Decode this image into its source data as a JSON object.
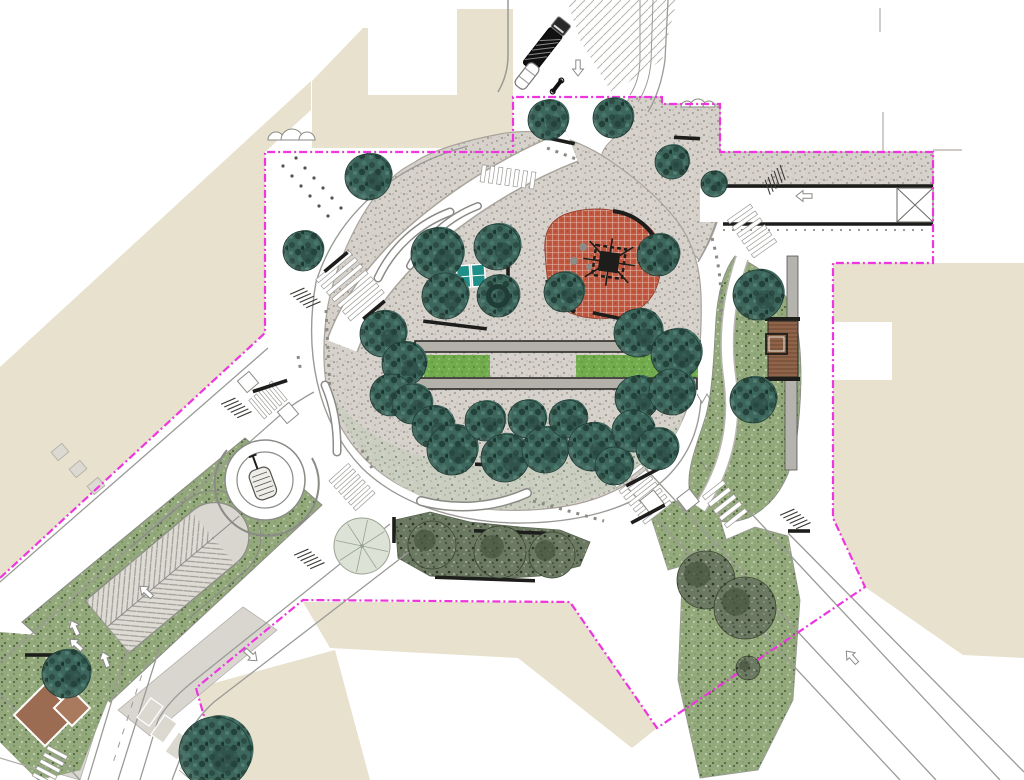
{
  "colors": {
    "building": "#e7e1cd",
    "boundary": "#ee35df",
    "gravelBase": "#d6d2cb",
    "gravelGreenBase": "#c9cdbf",
    "lawnBase": "#72ab4e",
    "plantBase": "#93a97c",
    "shrubBase": "#6b7862",
    "treeBase": "#3c655c",
    "playRed": "#c2573f",
    "deckWood": "#8a5f45",
    "sandBrown": "#9b6c52",
    "roadLine": "#9a9a96",
    "curb": "#1d1d1b"
  },
  "trees": [
    {
      "x": 548,
      "y": 120,
      "r": 20
    },
    {
      "x": 613,
      "y": 118,
      "r": 20
    },
    {
      "x": 672,
      "y": 162,
      "r": 17
    },
    {
      "x": 714,
      "y": 184,
      "r": 13
    },
    {
      "x": 368,
      "y": 177,
      "r": 23
    },
    {
      "x": 303,
      "y": 251,
      "r": 20
    },
    {
      "x": 437,
      "y": 254,
      "r": 26
    },
    {
      "x": 497,
      "y": 247,
      "r": 23
    },
    {
      "x": 445,
      "y": 296,
      "r": 23
    },
    {
      "x": 498,
      "y": 296,
      "r": 21,
      "donut": true
    },
    {
      "x": 564,
      "y": 292,
      "r": 20
    },
    {
      "x": 658,
      "y": 255,
      "r": 21
    },
    {
      "x": 383,
      "y": 334,
      "r": 23
    },
    {
      "x": 404,
      "y": 364,
      "r": 22
    },
    {
      "x": 391,
      "y": 395,
      "r": 21
    },
    {
      "x": 412,
      "y": 404,
      "r": 20
    },
    {
      "x": 433,
      "y": 427,
      "r": 21
    },
    {
      "x": 452,
      "y": 450,
      "r": 25
    },
    {
      "x": 485,
      "y": 421,
      "r": 20
    },
    {
      "x": 505,
      "y": 458,
      "r": 24
    },
    {
      "x": 527,
      "y": 419,
      "r": 19
    },
    {
      "x": 545,
      "y": 450,
      "r": 23
    },
    {
      "x": 568,
      "y": 419,
      "r": 19
    },
    {
      "x": 592,
      "y": 447,
      "r": 24
    },
    {
      "x": 638,
      "y": 333,
      "r": 24
    },
    {
      "x": 676,
      "y": 354,
      "r": 25
    },
    {
      "x": 637,
      "y": 398,
      "r": 22
    },
    {
      "x": 672,
      "y": 392,
      "r": 23
    },
    {
      "x": 633,
      "y": 431,
      "r": 21
    },
    {
      "x": 657,
      "y": 449,
      "r": 21
    },
    {
      "x": 614,
      "y": 466,
      "r": 19
    },
    {
      "x": 758,
      "y": 295,
      "r": 25
    },
    {
      "x": 753,
      "y": 400,
      "r": 23
    },
    {
      "x": 66,
      "y": 674,
      "r": 24
    },
    {
      "x": 215,
      "y": 753,
      "r": 36
    }
  ],
  "sketchTrees": [
    {
      "x": 362,
      "y": 546,
      "r": 28
    }
  ],
  "shrubBlobs": [
    {
      "x": 432,
      "y": 545,
      "r": 24
    },
    {
      "x": 500,
      "y": 552,
      "r": 26
    },
    {
      "x": 552,
      "y": 555,
      "r": 23
    },
    {
      "x": 706,
      "y": 580,
      "r": 29
    },
    {
      "x": 745,
      "y": 608,
      "r": 31
    },
    {
      "x": 748,
      "y": 668,
      "r": 12
    }
  ],
  "bikeRacks": [
    {
      "x": 303,
      "y": 296,
      "a": 40
    },
    {
      "x": 234,
      "y": 406,
      "a": 40
    },
    {
      "x": 773,
      "y": 182,
      "a": -45
    },
    {
      "x": 793,
      "y": 517,
      "a": 40
    },
    {
      "x": 307,
      "y": 557,
      "a": 40
    }
  ],
  "arrows": [
    {
      "x": 578,
      "y": 60,
      "a": 90
    },
    {
      "x": 812,
      "y": 196,
      "a": 180
    },
    {
      "x": 152,
      "y": 597,
      "a": 222
    },
    {
      "x": 82,
      "y": 650,
      "a": 222
    },
    {
      "x": 245,
      "y": 650,
      "a": 42
    },
    {
      "x": 857,
      "y": 663,
      "a": 228
    },
    {
      "x": 700,
      "y": 588,
      "a": 48
    },
    {
      "x": 108,
      "y": 667,
      "a": 250
    },
    {
      "x": 78,
      "y": 635,
      "a": 245
    }
  ],
  "parkingBays": [
    {
      "x": 150,
      "y": 712,
      "a": -55
    },
    {
      "x": 164,
      "y": 729,
      "a": -55
    },
    {
      "x": 178,
      "y": 746,
      "a": -55
    },
    {
      "x": 192,
      "y": 763,
      "a": -55
    },
    {
      "x": 206,
      "y": 779,
      "a": -55
    }
  ],
  "pitSquares": [
    {
      "x": 60,
      "y": 452
    },
    {
      "x": 78,
      "y": 469
    },
    {
      "x": 96,
      "y": 486
    }
  ],
  "bars": [
    {
      "x": 455,
      "y": 325,
      "len": 64,
      "a": 7
    },
    {
      "x": 627,
      "y": 320,
      "len": 70,
      "a": 12
    },
    {
      "x": 270,
      "y": 386,
      "len": 36,
      "a": -18
    },
    {
      "x": 508,
      "y": 272,
      "len": 20,
      "a": 90
    },
    {
      "x": 336,
      "y": 262,
      "len": 30,
      "a": -40
    },
    {
      "x": 374,
      "y": 310,
      "len": 28,
      "a": -40
    },
    {
      "x": 562,
      "y": 141,
      "len": 26,
      "a": 12
    },
    {
      "x": 643,
      "y": 477,
      "len": 38,
      "a": -28
    },
    {
      "x": 648,
      "y": 514,
      "len": 38,
      "a": -28
    },
    {
      "x": 799,
      "y": 531,
      "len": 22,
      "a": 0
    },
    {
      "x": 687,
      "y": 138,
      "len": 26,
      "a": 3
    },
    {
      "x": 394,
      "y": 530,
      "len": 26,
      "a": 90
    },
    {
      "x": 510,
      "y": 532,
      "len": 72,
      "a": 2
    },
    {
      "x": 485,
      "y": 579,
      "len": 100,
      "a": 2
    },
    {
      "x": 497,
      "y": 465,
      "len": 44,
      "a": 2
    },
    {
      "x": 45,
      "y": 655,
      "len": 40,
      "a": 0
    }
  ],
  "zebras": [
    {
      "x": 350,
      "y": 286,
      "len": 54,
      "wid": 44,
      "a": 50,
      "n": 7
    },
    {
      "x": 508,
      "y": 177,
      "len": 54,
      "wid": 17,
      "a": 8,
      "n": 7
    },
    {
      "x": 752,
      "y": 231,
      "len": 46,
      "wid": 28,
      "a": 55,
      "n": 6
    },
    {
      "x": 643,
      "y": 494,
      "len": 50,
      "wid": 34,
      "a": 52,
      "n": 7
    },
    {
      "x": 725,
      "y": 504,
      "len": 40,
      "wid": 26,
      "a": 52,
      "n": 5
    },
    {
      "x": 268,
      "y": 400,
      "len": 30,
      "wid": 24,
      "a": -40,
      "n": 5
    },
    {
      "x": 352,
      "y": 487,
      "len": 40,
      "wid": 26,
      "a": 48,
      "n": 6
    },
    {
      "x": 50,
      "y": 766,
      "len": 34,
      "wid": 22,
      "a": -62,
      "n": 5
    },
    {
      "x": 201,
      "y": 765,
      "len": 36,
      "wid": 26,
      "a": -50,
      "n": 5
    }
  ],
  "refugeBoxes": [
    {
      "x": 248,
      "y": 382,
      "s": 15,
      "a": -40
    },
    {
      "x": 288,
      "y": 413,
      "s": 15,
      "a": -40
    },
    {
      "x": 652,
      "y": 502,
      "s": 17,
      "a": -38
    },
    {
      "x": 688,
      "y": 500,
      "s": 16,
      "a": -38
    }
  ],
  "gridDots": [
    {
      "x": 283,
      "y": 166
    },
    {
      "x": 292,
      "y": 176
    },
    {
      "x": 301,
      "y": 186
    },
    {
      "x": 310,
      "y": 196
    },
    {
      "x": 319,
      "y": 206
    },
    {
      "x": 328,
      "y": 216
    },
    {
      "x": 296,
      "y": 158
    },
    {
      "x": 305,
      "y": 168
    },
    {
      "x": 314,
      "y": 178
    },
    {
      "x": 323,
      "y": 188
    },
    {
      "x": 332,
      "y": 198
    },
    {
      "x": 341,
      "y": 208
    }
  ],
  "grayDots": [
    {
      "x": 583,
      "y": 247,
      "r": 4
    },
    {
      "x": 574,
      "y": 261,
      "r": 4
    },
    {
      "x": 589,
      "y": 267,
      "r": 3
    }
  ]
}
